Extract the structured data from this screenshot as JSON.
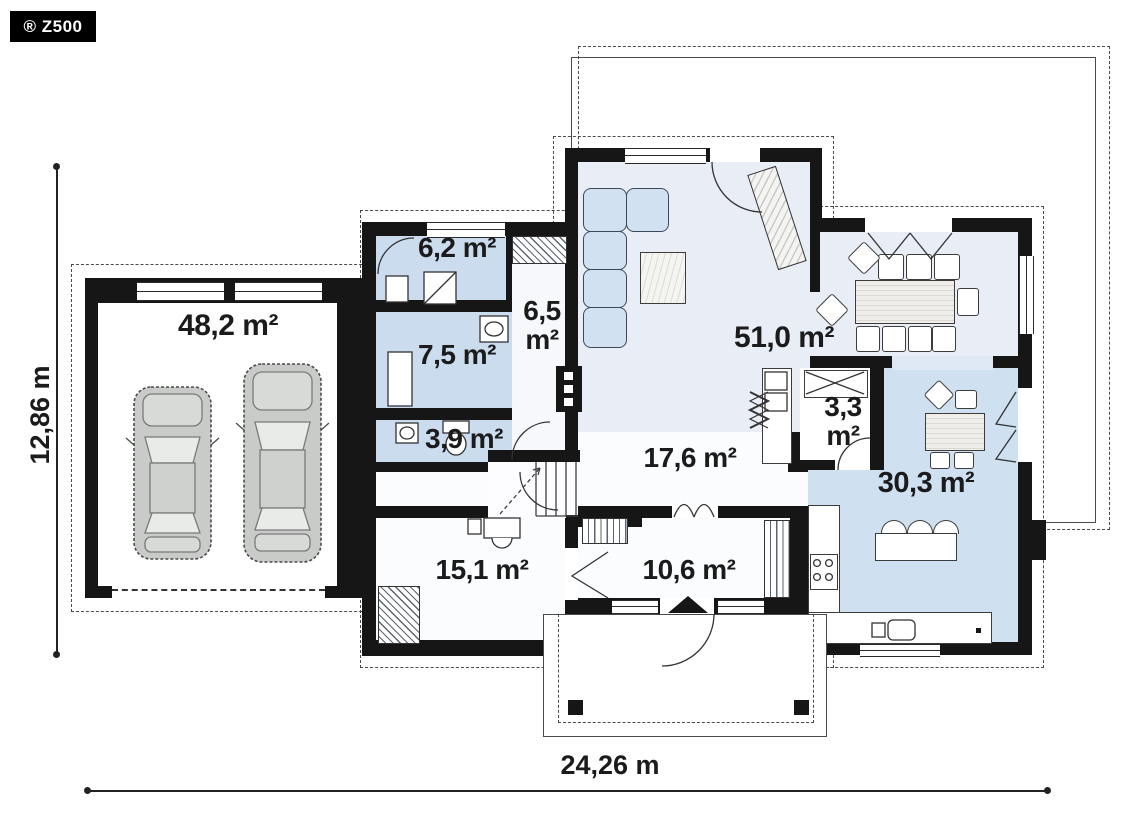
{
  "badge": {
    "label": "® Z500"
  },
  "dimensions": {
    "height": "12,86 m",
    "width": "24,26 m"
  },
  "plan": {
    "rooms": [
      {
        "name": "garage",
        "area": "48,2 m²"
      },
      {
        "name": "utility",
        "area": "6,2 m²"
      },
      {
        "name": "corridor",
        "area": "6,5 m²"
      },
      {
        "name": "bathroom",
        "area": "7,5 m²"
      },
      {
        "name": "wc",
        "area": "3,9 m²"
      },
      {
        "name": "living-room",
        "area": "51,0 m²"
      },
      {
        "name": "pantry",
        "area": "3,3 m²"
      },
      {
        "name": "hall",
        "area": "17,6 m²"
      },
      {
        "name": "kitchen-dining",
        "area": "30,3 m²"
      },
      {
        "name": "room",
        "area": "15,1 m²"
      },
      {
        "name": "vestibule",
        "area": "10,6 m²"
      }
    ],
    "colors": {
      "wall": "#161616",
      "room_blue": "#ccdcef",
      "living_blue": "#e9eef6",
      "kitchen_blue": "#cfe0f0",
      "car_gray": "#c9cbc9"
    }
  }
}
